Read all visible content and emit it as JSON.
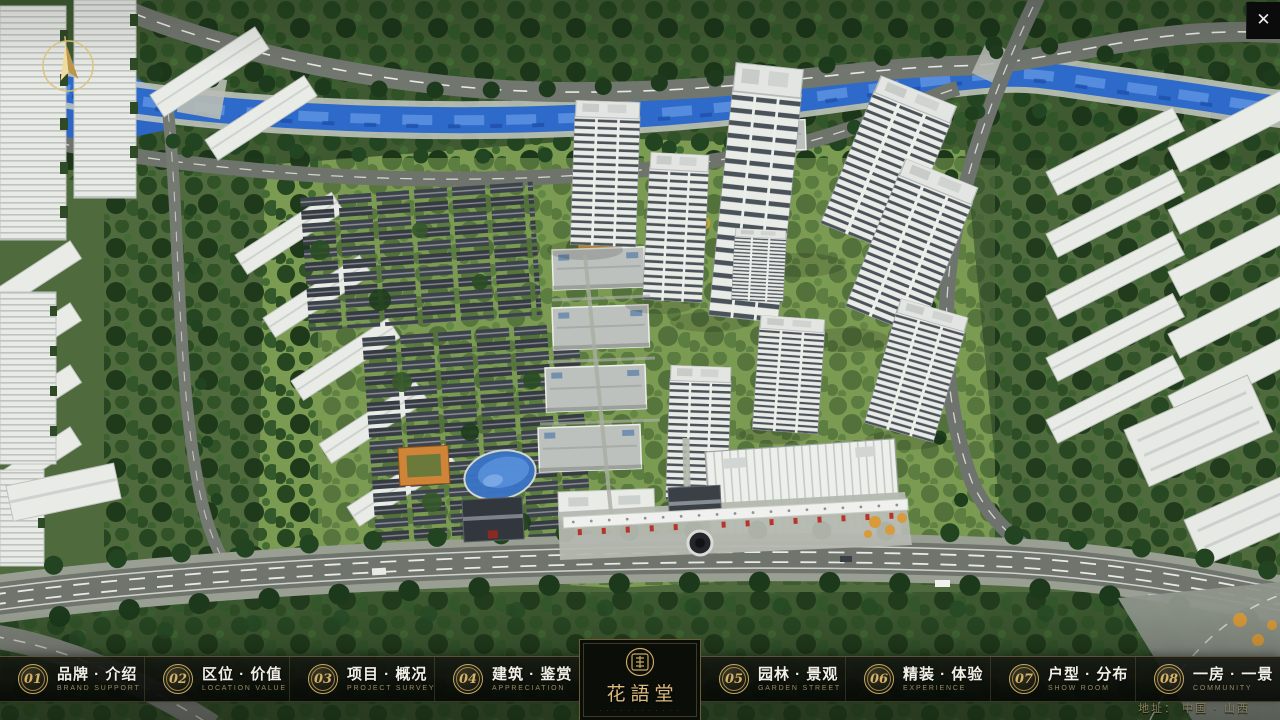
{
  "close_label": "✕",
  "logo": {
    "title": "花語堂",
    "subtitle_dots": "· · · · · · · · · · · ·"
  },
  "address": "地址：  中国 · 山西",
  "nav": {
    "items": [
      {
        "num": "01",
        "zh": "品牌 · 介绍",
        "en": "BRAND SUPPORT"
      },
      {
        "num": "02",
        "zh": "区位 · 价值",
        "en": "LOCATION VALUE"
      },
      {
        "num": "03",
        "zh": "项目 · 概况",
        "en": "PROJECT SURVEY"
      },
      {
        "num": "04",
        "zh": "建筑 · 鉴赏",
        "en": "APPRECIATION"
      },
      {
        "num": "05",
        "zh": "园林 · 景观",
        "en": "GARDEN STREET"
      },
      {
        "num": "06",
        "zh": "精装 · 体验",
        "en": "EXPERIENCE"
      },
      {
        "num": "07",
        "zh": "户型 · 分布",
        "en": "SHOW ROOM"
      },
      {
        "num": "08",
        "zh": "一房 · 一景",
        "en": "COMMUNITY"
      }
    ]
  },
  "colors": {
    "gold": "#c9a860",
    "bar_bg": "#0b0d09",
    "river_blue": "#2d6ac9"
  }
}
